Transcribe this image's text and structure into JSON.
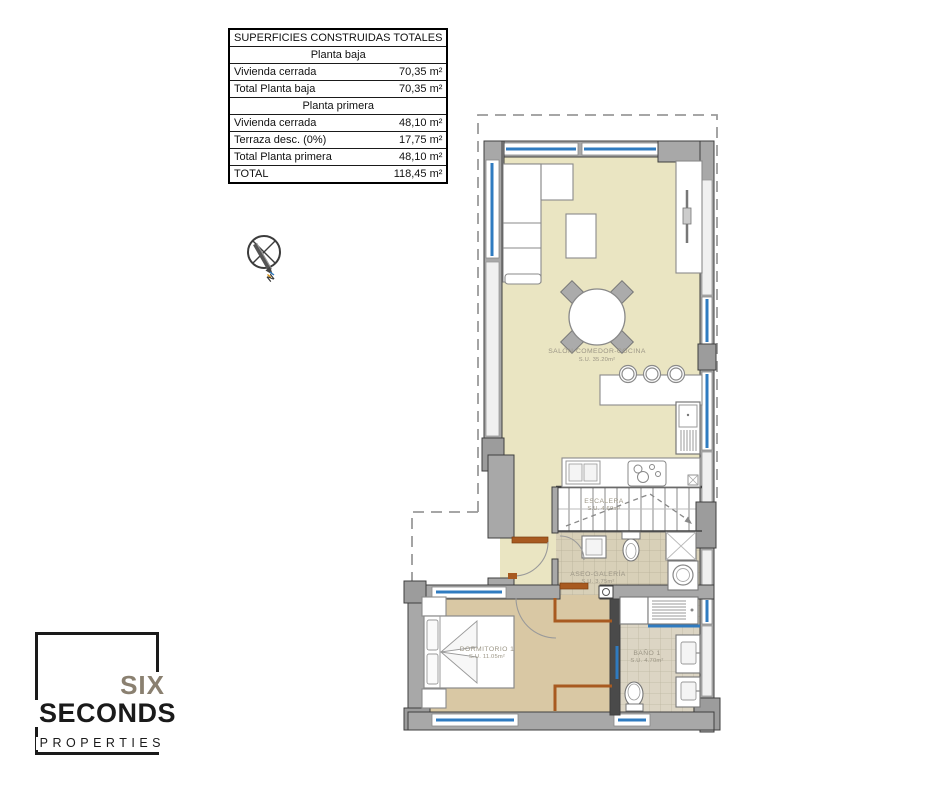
{
  "surface_table": {
    "rows": [
      {
        "label": "SUPERFICIES CONSTRUIDAS TOTALES"
      },
      {
        "label": "Planta baja"
      },
      {
        "label": "Vivienda cerrada",
        "value": "70,35 m²"
      },
      {
        "label": "Total Planta baja",
        "value": "70,35 m²"
      },
      {
        "label": "Planta primera"
      },
      {
        "label": "Vivienda cerrada",
        "value": "48,10 m²"
      },
      {
        "label": "Terraza desc. (0%)",
        "value": "17,75 m²"
      },
      {
        "label": "Total Planta primera",
        "value": "48,10 m²"
      },
      {
        "label": "TOTAL",
        "value": "118,45 m²"
      }
    ]
  },
  "compass": {
    "label": "N"
  },
  "floorplan": {
    "rooms": [
      {
        "name": "SALÓN-COMEDOR-COCINA",
        "area": "S.U. 35.20m²"
      },
      {
        "name": "ESCALERA",
        "area": "S.U. 4.60m²"
      },
      {
        "name": "ASEO-GALERÍA",
        "area": "S.U. 3.75m²"
      },
      {
        "name": "DORMITORIO 1",
        "area": "S.U. 11.05m²"
      },
      {
        "name": "BAÑO 1",
        "area": "S.U. 4.70m²"
      }
    ]
  },
  "logo": {
    "word1": "SIX",
    "word2": "SECONDS",
    "word3": "PROPERTIES"
  },
  "colors": {
    "window_blue": "#2F7BC0",
    "door_brown": "#A85A20",
    "wall_gray": "#A8A8A8",
    "floor_living": "#EAE5C2",
    "floor_bedroom": "#D9C8A4",
    "floor_tile": "#DCD5C0",
    "logo_taupe": "#8A8070"
  }
}
